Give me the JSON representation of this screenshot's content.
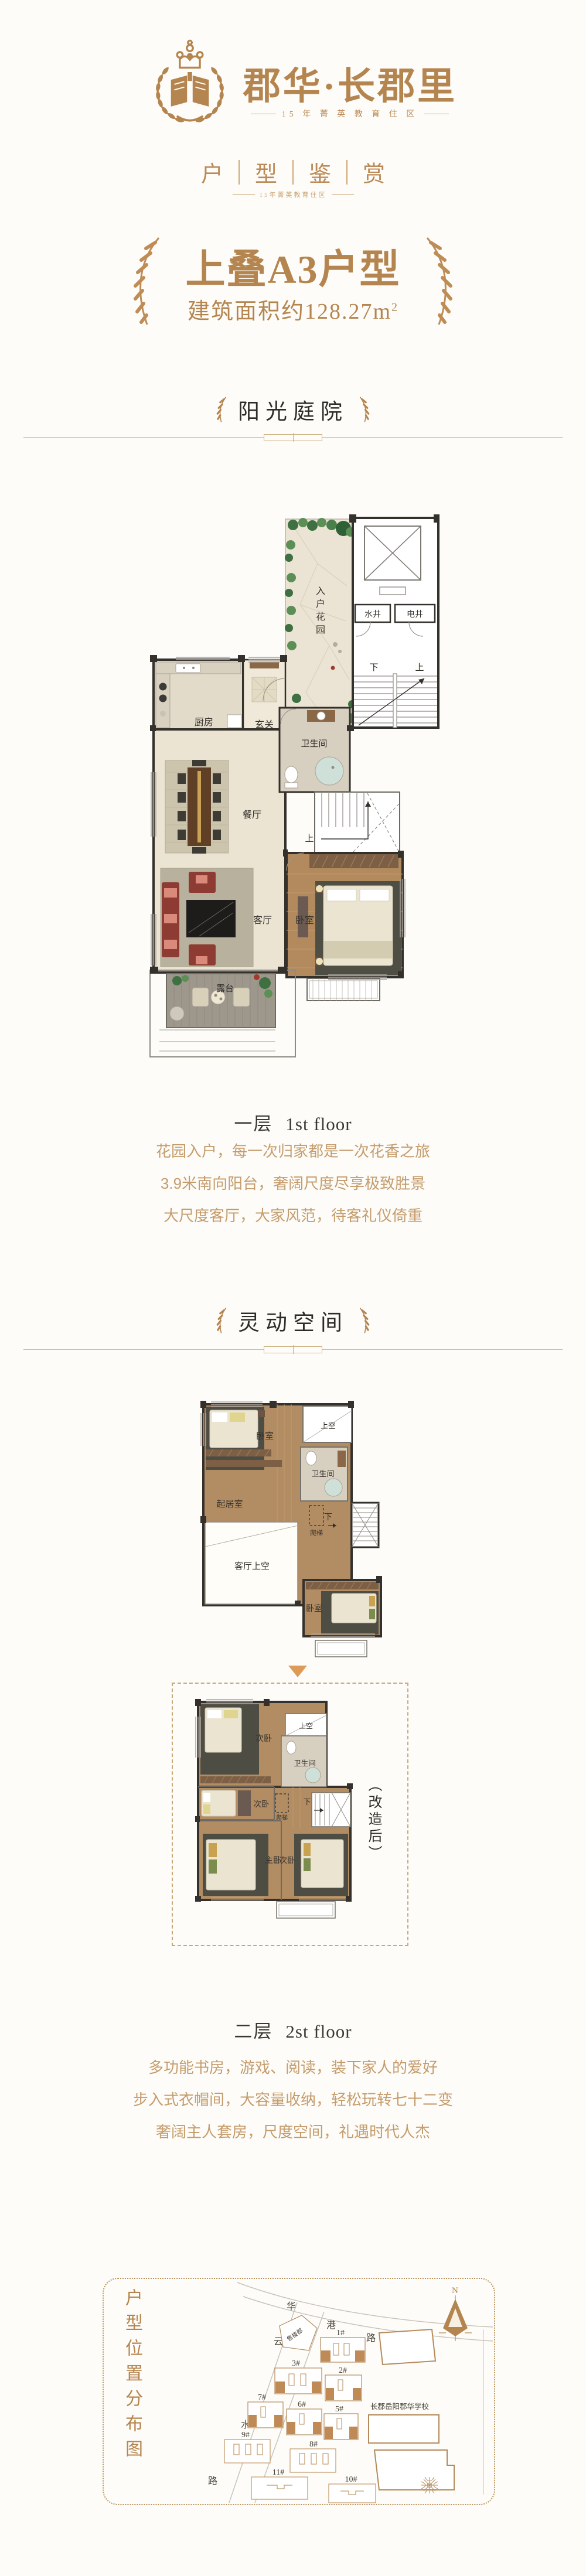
{
  "colors": {
    "gold": "#b5854f",
    "gold_soft": "#c59c6d",
    "dark": "#332f2b",
    "orange": "#de9b58"
  },
  "logo": {
    "brand": "郡华·长郡里",
    "tagline": "15 年 菁 英 教 育 住 区"
  },
  "appreciation": {
    "chars": [
      "户",
      "型",
      "鉴",
      "赏"
    ],
    "tagline": "15年菁英教育住区"
  },
  "unit": {
    "title": "上叠A3户型",
    "area": "建筑面积约128.27m",
    "area_sup": "2"
  },
  "floor1": {
    "badge": "阳光庭院",
    "label_cn": "一层",
    "label_en": "1st floor",
    "desc": [
      "花园入户，每一次归家都是一次花香之旅",
      "3.9米南向阳台，奢阔尺度尽享极致胜景",
      "大尺度客厅，大家风范，待客礼仪倚重"
    ],
    "rooms": {
      "entry_garden": [
        "入",
        "户",
        "花",
        "园"
      ],
      "water_shaft": "水井",
      "electric_shaft": "电井",
      "stair_down": "下",
      "stair_up": "上",
      "kitchen": "厨房",
      "foyer": "玄关",
      "bathroom": "卫生间",
      "dining": "餐厅",
      "stairs_up": "上",
      "living": "客厅",
      "bedroom": "卧室",
      "terrace": "露台"
    }
  },
  "floor2": {
    "badge": "灵动空间",
    "label_cn": "二层",
    "label_en": "2st floor",
    "desc": [
      "多功能书房，游戏、阅读，装下家人的爱好",
      "步入式衣帽间，大容量收纳，轻松玩转七十二变",
      "奢阔主人套房，尺度空间，礼遇时代人杰"
    ],
    "upper": {
      "bedroom": "卧室",
      "void": "上空",
      "bathroom": "卫生间",
      "family_room": "起居室",
      "ladder": "爬梯",
      "stair_down": "下",
      "living_void": "客厅上空",
      "bedroom2": "卧室"
    },
    "renovated": {
      "tag": "（改造后）",
      "bedroom_a": "次卧",
      "void": "上空",
      "bathroom": "卫生间",
      "bedroom_b": "次卧",
      "ladder": "爬梯",
      "stair_down": "下",
      "master": "主卧",
      "bedroom_c": "次卧"
    }
  },
  "sitemap": {
    "title": "户型位置分布图",
    "compass_n": "N",
    "road1": [
      "华",
      "港",
      "路"
    ],
    "road2": [
      "云",
      "水",
      "路"
    ],
    "sales_office": "售楼部",
    "school": "长郡岳阳郡华学校",
    "buildings": [
      "1#",
      "2#",
      "3#",
      "5#",
      "6#",
      "7#",
      "8#",
      "9#",
      "10#",
      "11#"
    ]
  }
}
